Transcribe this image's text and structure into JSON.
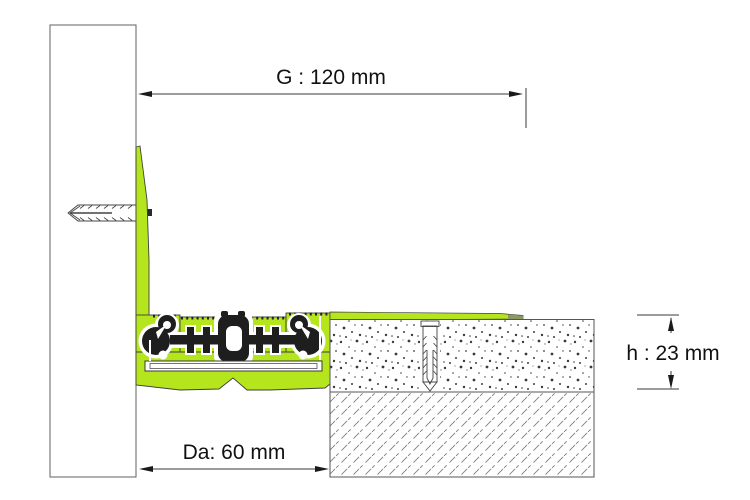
{
  "labels": {
    "g": "G : 120 mm",
    "h": "h : 23 mm",
    "da": "Da: 60 mm"
  },
  "colors": {
    "profile_green": "#b5e61d",
    "flange_tip_gray": "#8a9a60",
    "mechanism_dark": "#1e1e1e",
    "drawing_line": "#3a3a3a",
    "hatch_line": "#8a8a8a",
    "dimension_text": "#111111"
  }
}
